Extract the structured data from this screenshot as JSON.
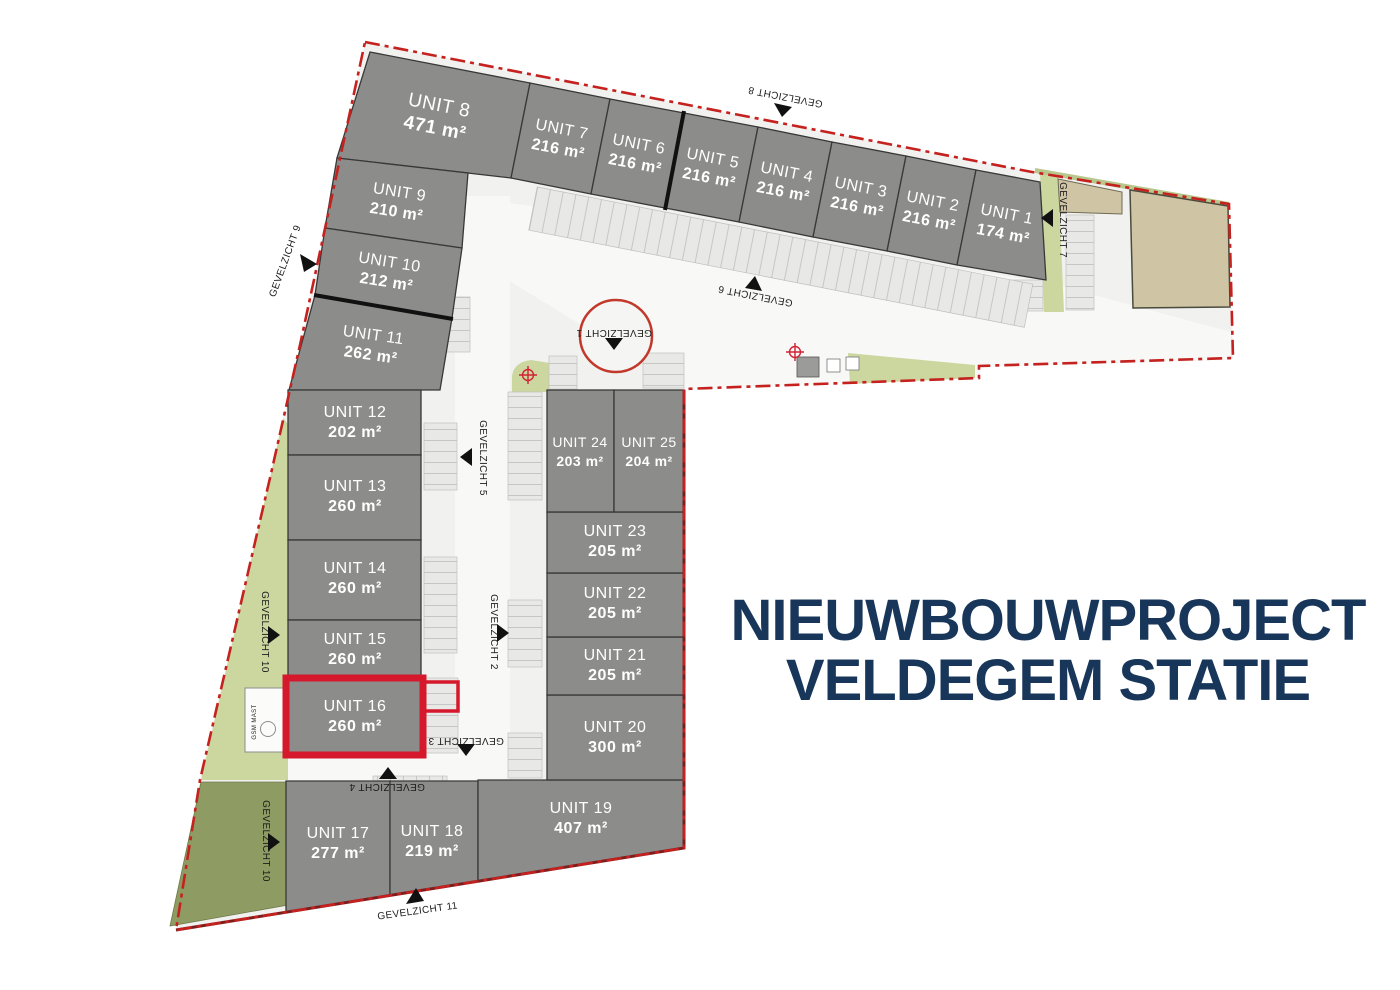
{
  "title": {
    "line1": "NIEUWBOUWPROJECT",
    "line2": "VELDEGEM STATIE"
  },
  "units": [
    {
      "label": "UNIT 1",
      "area": "174 m²"
    },
    {
      "label": "UNIT 2",
      "area": "216 m²"
    },
    {
      "label": "UNIT 3",
      "area": "216 m²"
    },
    {
      "label": "UNIT 4",
      "area": "216 m²"
    },
    {
      "label": "UNIT 5",
      "area": "216 m²"
    },
    {
      "label": "UNIT 6",
      "area": "216 m²"
    },
    {
      "label": "UNIT 7",
      "area": "216 m²"
    },
    {
      "label": "UNIT 8",
      "area": "471 m²"
    },
    {
      "label": "UNIT 9",
      "area": "210 m²"
    },
    {
      "label": "UNIT 10",
      "area": "212 m²"
    },
    {
      "label": "UNIT 11",
      "area": "262 m²"
    },
    {
      "label": "UNIT 12",
      "area": "202 m²"
    },
    {
      "label": "UNIT 13",
      "area": "260 m²"
    },
    {
      "label": "UNIT 14",
      "area": "260 m²"
    },
    {
      "label": "UNIT 15",
      "area": "260 m²"
    },
    {
      "label": "UNIT 16",
      "area": "260 m²",
      "highlighted": true
    },
    {
      "label": "UNIT 17",
      "area": "277 m²"
    },
    {
      "label": "UNIT 18",
      "area": "219 m²"
    },
    {
      "label": "UNIT 19",
      "area": "407 m²"
    },
    {
      "label": "UNIT 20",
      "area": "300 m²"
    },
    {
      "label": "UNIT 21",
      "area": "205 m²"
    },
    {
      "label": "UNIT 22",
      "area": "205 m²"
    },
    {
      "label": "UNIT 23",
      "area": "205 m²"
    },
    {
      "label": "UNIT 24",
      "area": "203 m²"
    },
    {
      "label": "UNIT 25",
      "area": "204 m²"
    }
  ],
  "gevelzicht": {
    "g1": "GEVELZICHT 1",
    "g2": "GEVELZICHT 2",
    "g3": "GEVELZICHT 3",
    "g4": "GEVELZICHT 4",
    "g5": "GEVELZICHT 5",
    "g6": "GEVELZICHT 6",
    "g7": "GEVELZICHT 7",
    "g8": "GEVELZICHT 8",
    "g9": "GEVELZICHT 9",
    "g10": "GEVELZICHT 10",
    "g11": "GEVELZICHT 11"
  },
  "annotations": {
    "gsm_mast": "GSM MAST"
  },
  "colors": {
    "accent_red": "#d5182b",
    "boundary_red": "#c4211f",
    "navy": "#17365a",
    "unit_gray": "#8c8c8a",
    "green_light": "#ccd7a0",
    "green_dark": "#8e9c64",
    "beige": "#cfc5a4"
  }
}
